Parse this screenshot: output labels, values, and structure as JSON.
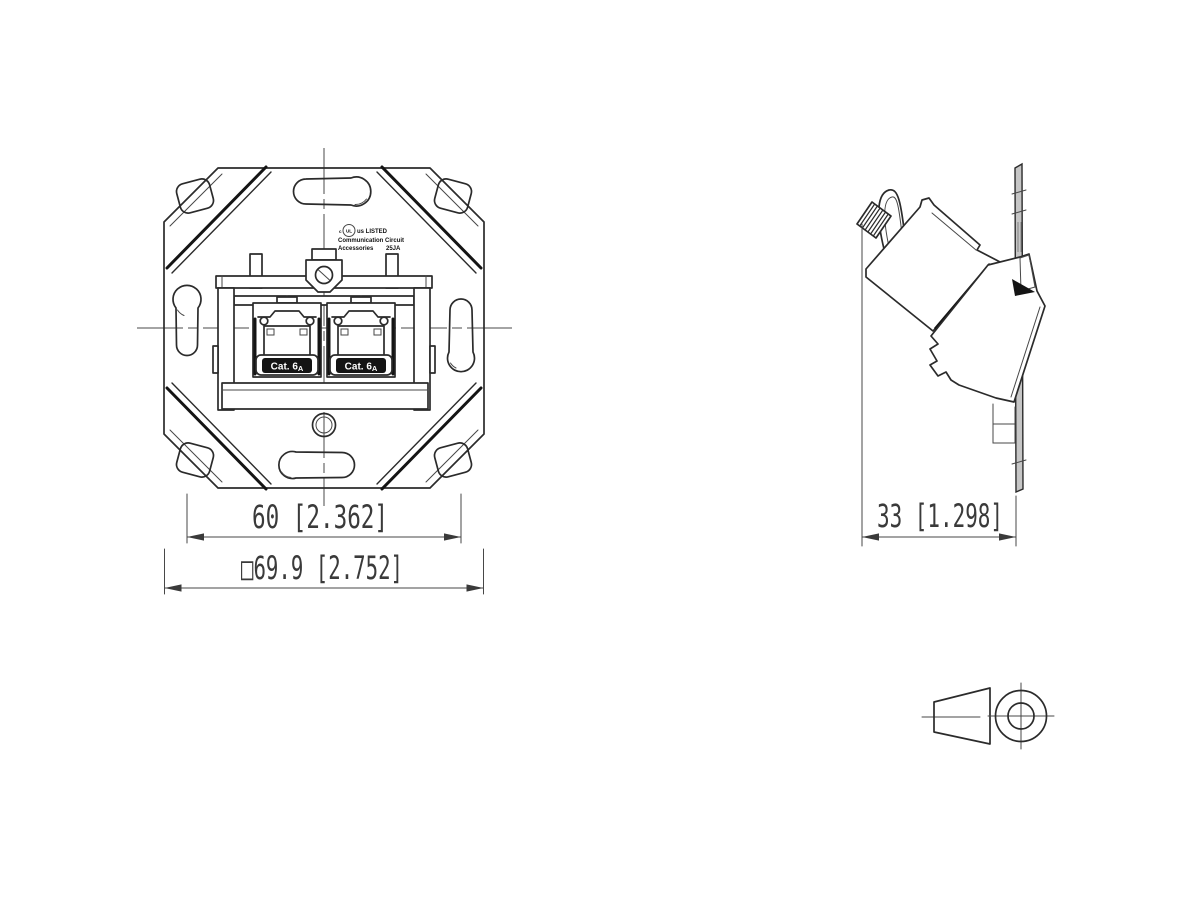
{
  "colors": {
    "background": "#ffffff",
    "line": "#2b2b2b",
    "thin_line": "#474747",
    "dark_fill": "#141414",
    "plate_fill": "#c6c6c6",
    "label_bg": "#111111",
    "label_text": "#ffffff",
    "dim_text": "#3a3a3a"
  },
  "front_view": {
    "dim_screw_spacing": "60 [2.362]",
    "dim_plate_size": "□69.9 [2.752]",
    "jacks": [
      {
        "label": "Cat. 6",
        "label_sub": "A"
      },
      {
        "label": "Cat. 6",
        "label_sub": "A"
      }
    ],
    "cert_mark": {
      "l1_left": "c",
      "l1_logo": "UL",
      "l1_right": "us LISTED",
      "l2": "Communication Circuit",
      "l3_left": "Accessories",
      "l3_right": "25JA"
    }
  },
  "side_view": {
    "dim_depth": "33 [1.298]"
  }
}
